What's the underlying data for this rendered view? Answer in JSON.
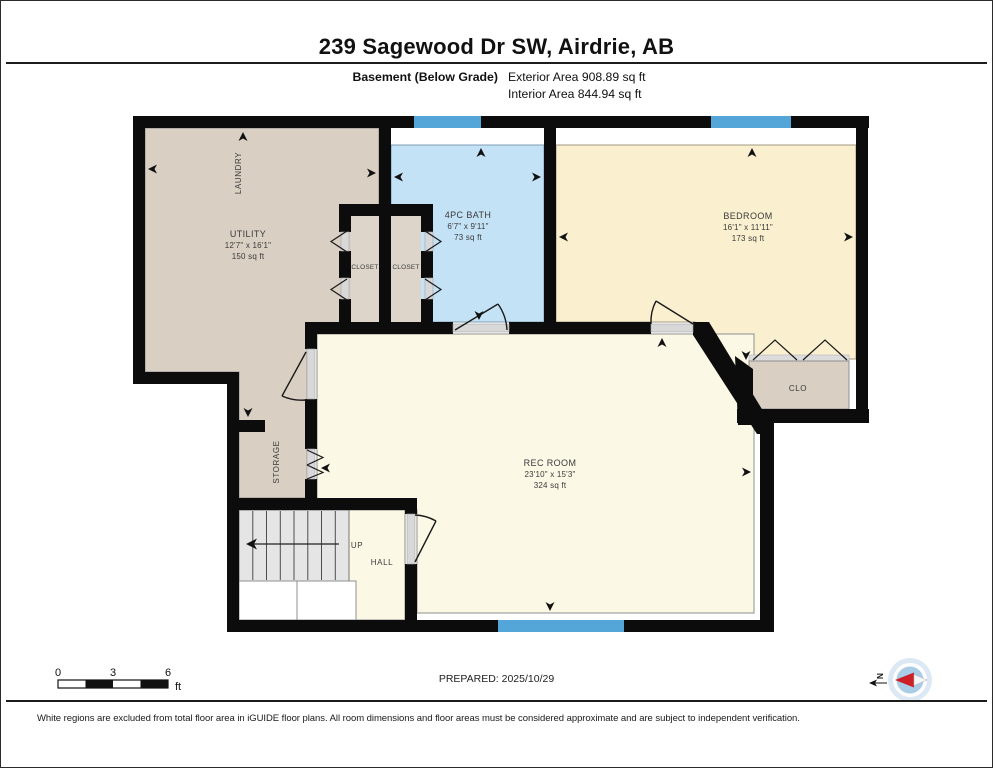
{
  "header": {
    "title": "239 Sagewood Dr SW, Airdrie, AB",
    "floor_label": "Basement (Below Grade)",
    "exterior_area": "Exterior Area 908.89 sq ft",
    "interior_area": "Interior Area 844.94 sq ft"
  },
  "rooms": {
    "utility": {
      "name": "UTILITY",
      "dims": "12'7\" x 16'1\"",
      "area": "150 sq ft"
    },
    "laundry_label": "LAUNDRY",
    "closet_left": "CLOSET",
    "closet_right": "CLOSET",
    "bath": {
      "name": "4PC BATH",
      "dims": "6'7\" x 9'11\"",
      "area": "73 sq ft"
    },
    "bedroom": {
      "name": "BEDROOM",
      "dims": "16'1\" x 11'11\"",
      "area": "173 sq ft"
    },
    "clo_label": "CLO",
    "storage_label": "STORAGE",
    "rec_room": {
      "name": "REC ROOM",
      "dims": "23'10\" x 15'3\"",
      "area": "324 sq ft"
    },
    "hall_label": "HALL",
    "stairs_label": "UP"
  },
  "scale_bar": {
    "ticks": [
      "0",
      "3",
      "6"
    ],
    "unit": "ft"
  },
  "compass": {
    "north_label": "N"
  },
  "footer": {
    "prepared": "PREPARED: 2025/10/29",
    "disclaimer": "White regions are excluded from total floor area in iGUIDE floor plans. All room dimensions and floor areas must be considered approximate and are subject to independent verification."
  },
  "colors": {
    "wall": "#0c0c0c",
    "tan_room": "#d9cfc3",
    "bath_blue": "#c4e2f5",
    "bedroom_cream": "#faf0cf",
    "rec_cream": "#fcf8e6",
    "window_blue": "#54a6d9",
    "stairs_gray": "#e5e5e5",
    "compass_red": "#cc2027"
  }
}
